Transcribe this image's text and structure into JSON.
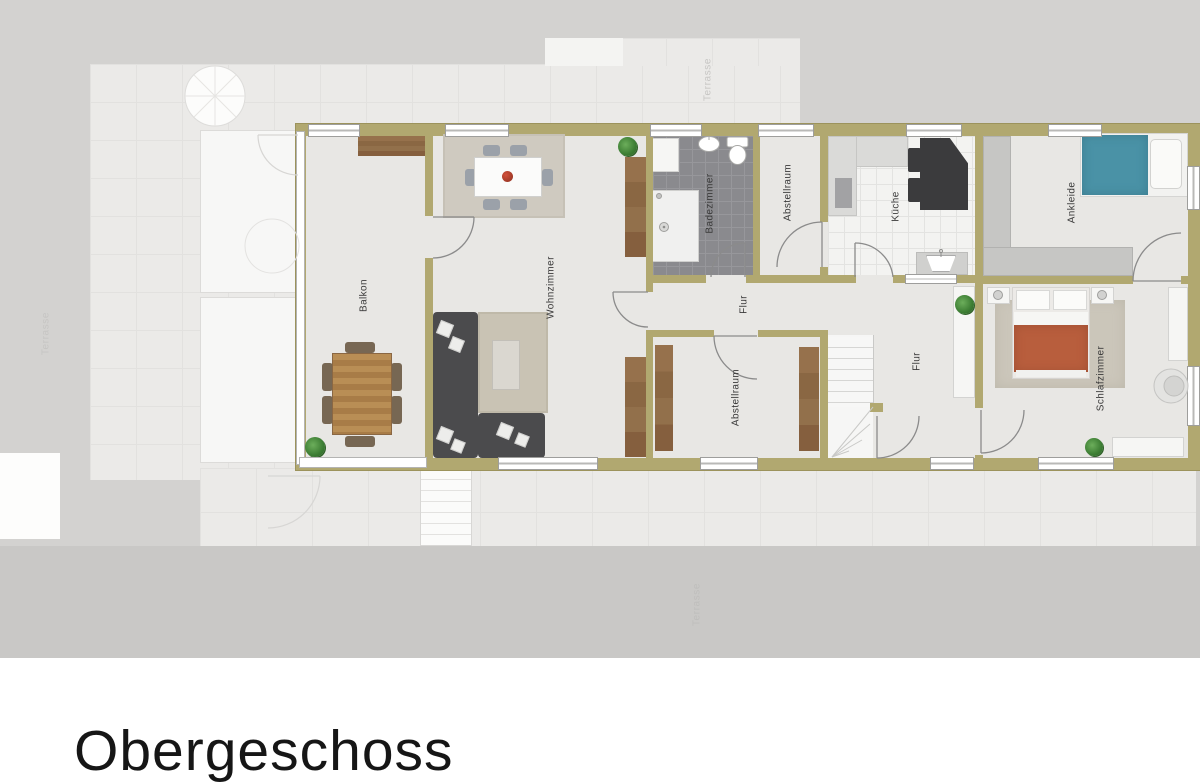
{
  "title": "Obergeschoss",
  "plan": {
    "rooms": [
      {
        "id": "balkon",
        "label": "Balkon"
      },
      {
        "id": "wohnzimmer",
        "label": "Wohnzimmer"
      },
      {
        "id": "badezimmer",
        "label": "Badezimmer"
      },
      {
        "id": "abstellraum-oben",
        "label": "Abstellraum"
      },
      {
        "id": "kueche",
        "label": "Küche"
      },
      {
        "id": "ankleide",
        "label": "Ankleide"
      },
      {
        "id": "flur-oben",
        "label": "Flur"
      },
      {
        "id": "abstellraum-unten",
        "label": "Abstellraum"
      },
      {
        "id": "flur-rechts",
        "label": "Flur"
      },
      {
        "id": "schlafzimmer",
        "label": "Schlafzimmer"
      }
    ],
    "outdoor_labels": [
      {
        "id": "terrasse-oben",
        "label": "Terrasse"
      },
      {
        "id": "terrasse-links",
        "label": "Terrasse"
      },
      {
        "id": "terrasse-unten",
        "label": "Terrasse"
      }
    ]
  },
  "colors": {
    "wall": "#b1a870",
    "floor": "#e8e7e4",
    "bath_tile": "#8a8a8e",
    "wood": "#8d6746",
    "sofa": "#4b4b4d",
    "bed_teal": "#4a92a6",
    "bed_orange": "#b85e3d",
    "plant_green": "#3f8f3a",
    "background_gray": "#d3d2d0"
  }
}
